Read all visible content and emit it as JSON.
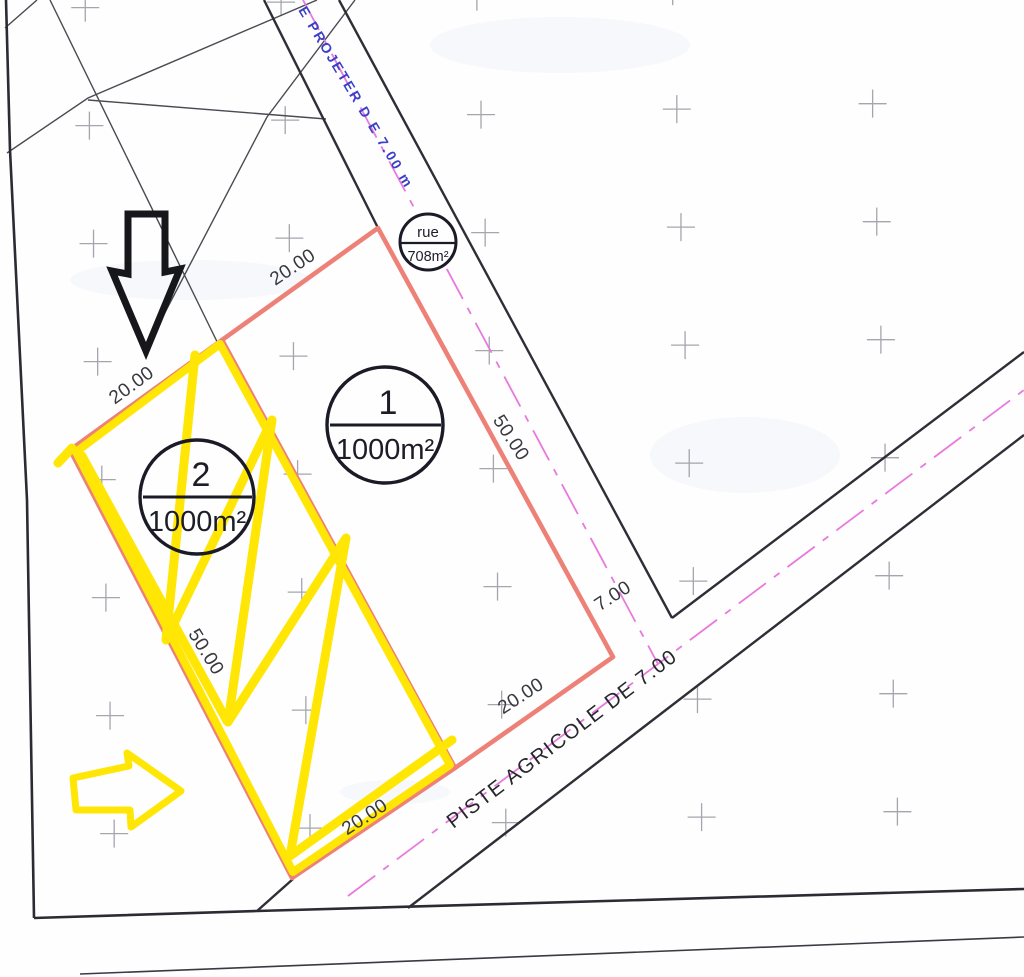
{
  "map": {
    "road_top_label": "E  PROJETER  D E  7.00  m",
    "road_bottom_label": "PISTE AGRICOLE  DE 7.00",
    "road_width_label": "7.00",
    "rue_circle": {
      "name": "rue",
      "area": "708m²"
    },
    "parcels": [
      {
        "number": "1",
        "area": "1000m²",
        "dims": {
          "top": "20.00",
          "side": "50.00",
          "bottom": "20.00"
        }
      },
      {
        "number": "2",
        "area": "1000m²",
        "dims": {
          "top": "20.00",
          "side": "50.00",
          "bottom": "20.00"
        }
      }
    ],
    "colors": {
      "parcel_red": "#ee8177",
      "highlight_yellow": "#ffe604",
      "centerline_magenta": "#e879dd",
      "road_text_blue": "#3c40c6"
    }
  }
}
